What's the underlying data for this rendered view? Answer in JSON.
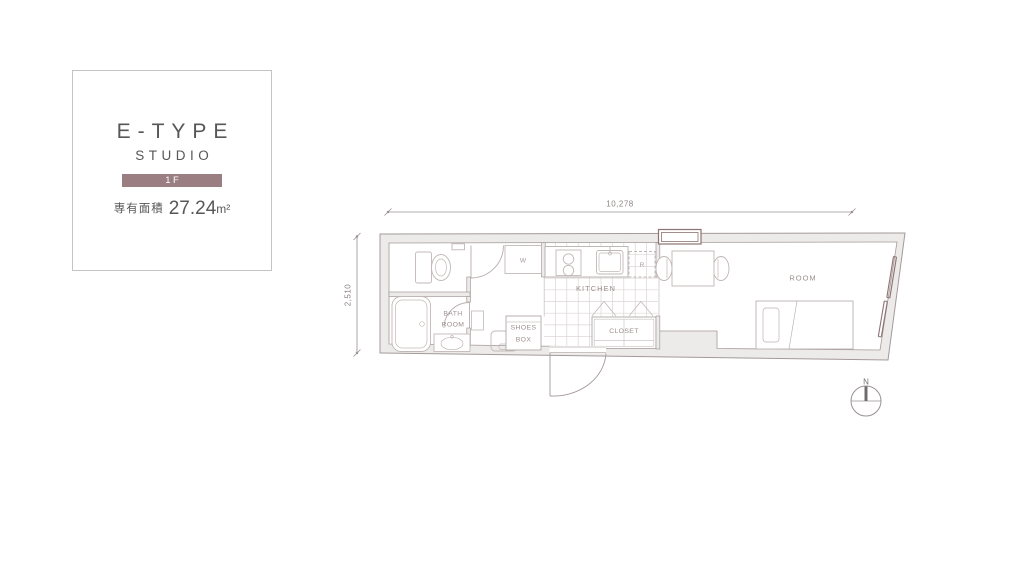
{
  "info_card": {
    "type_name": "E-TYPE",
    "layout_type": "STUDIO",
    "floor_badge": "1F",
    "area_label": "専有面積",
    "area_value": "27.24",
    "area_unit": "m²"
  },
  "floor_plan": {
    "dimension_width": "10,278",
    "dimension_height": "2,510",
    "labels": {
      "kitchen": "KITCHEN",
      "room": "ROOM",
      "closet": "CLOSET",
      "bath_line1": "BATH",
      "bath_line2": "ROOM",
      "shoes_line1": "SHOES",
      "shoes_line2": "BOX",
      "washer": "W",
      "fridge": "R"
    },
    "compass_north": "N"
  },
  "colors": {
    "accent_mauve": "#9a7e82",
    "title_gray": "#585656",
    "wall_fill": "#edebea",
    "wall_line": "#a59999",
    "fixture_line": "#c3b8b8",
    "label_color": "#9c8d8d",
    "window_accent": "#8d7373"
  }
}
